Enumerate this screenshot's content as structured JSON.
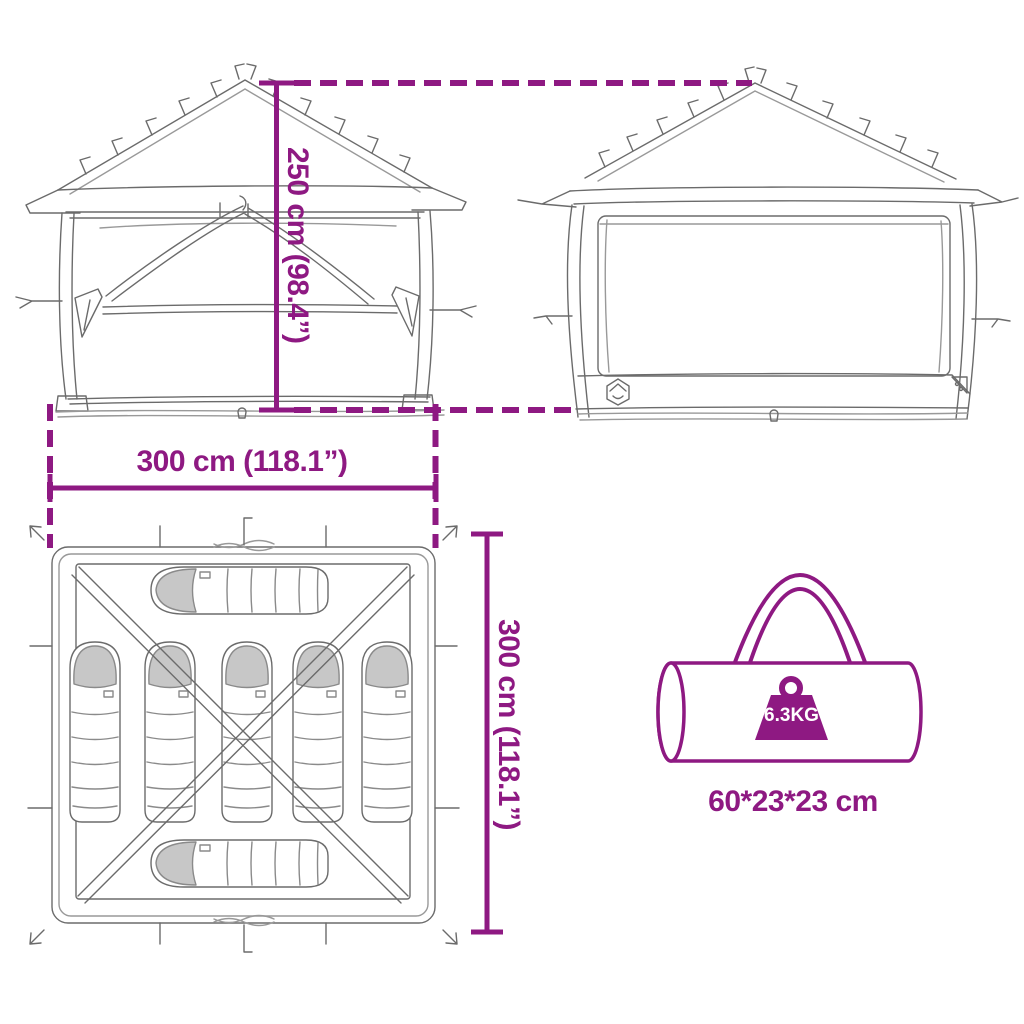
{
  "diagram": {
    "type": "product-dimension-diagram",
    "subject": "pop-up tent with carry bag"
  },
  "labels": {
    "height": "250 cm (98.4”)",
    "width": "300 cm (118.1”)",
    "depth": "300 cm (118.1”)",
    "bag_dimensions": "60*23*23 cm",
    "bag_weight": "6.3KG"
  },
  "colors": {
    "accent": "#8E1982",
    "line_art": "#6b6b6b",
    "line_art_light": "#999999",
    "sleeping_bag_head_fill": "#c7c7c7",
    "weight_label_text": "#ffffff",
    "background": "#ffffff"
  },
  "icons": {
    "weight": "weight-icon",
    "brand_badge": "hexagon-tent-logo-icon",
    "carry_bag": "carry-bag-icon"
  }
}
